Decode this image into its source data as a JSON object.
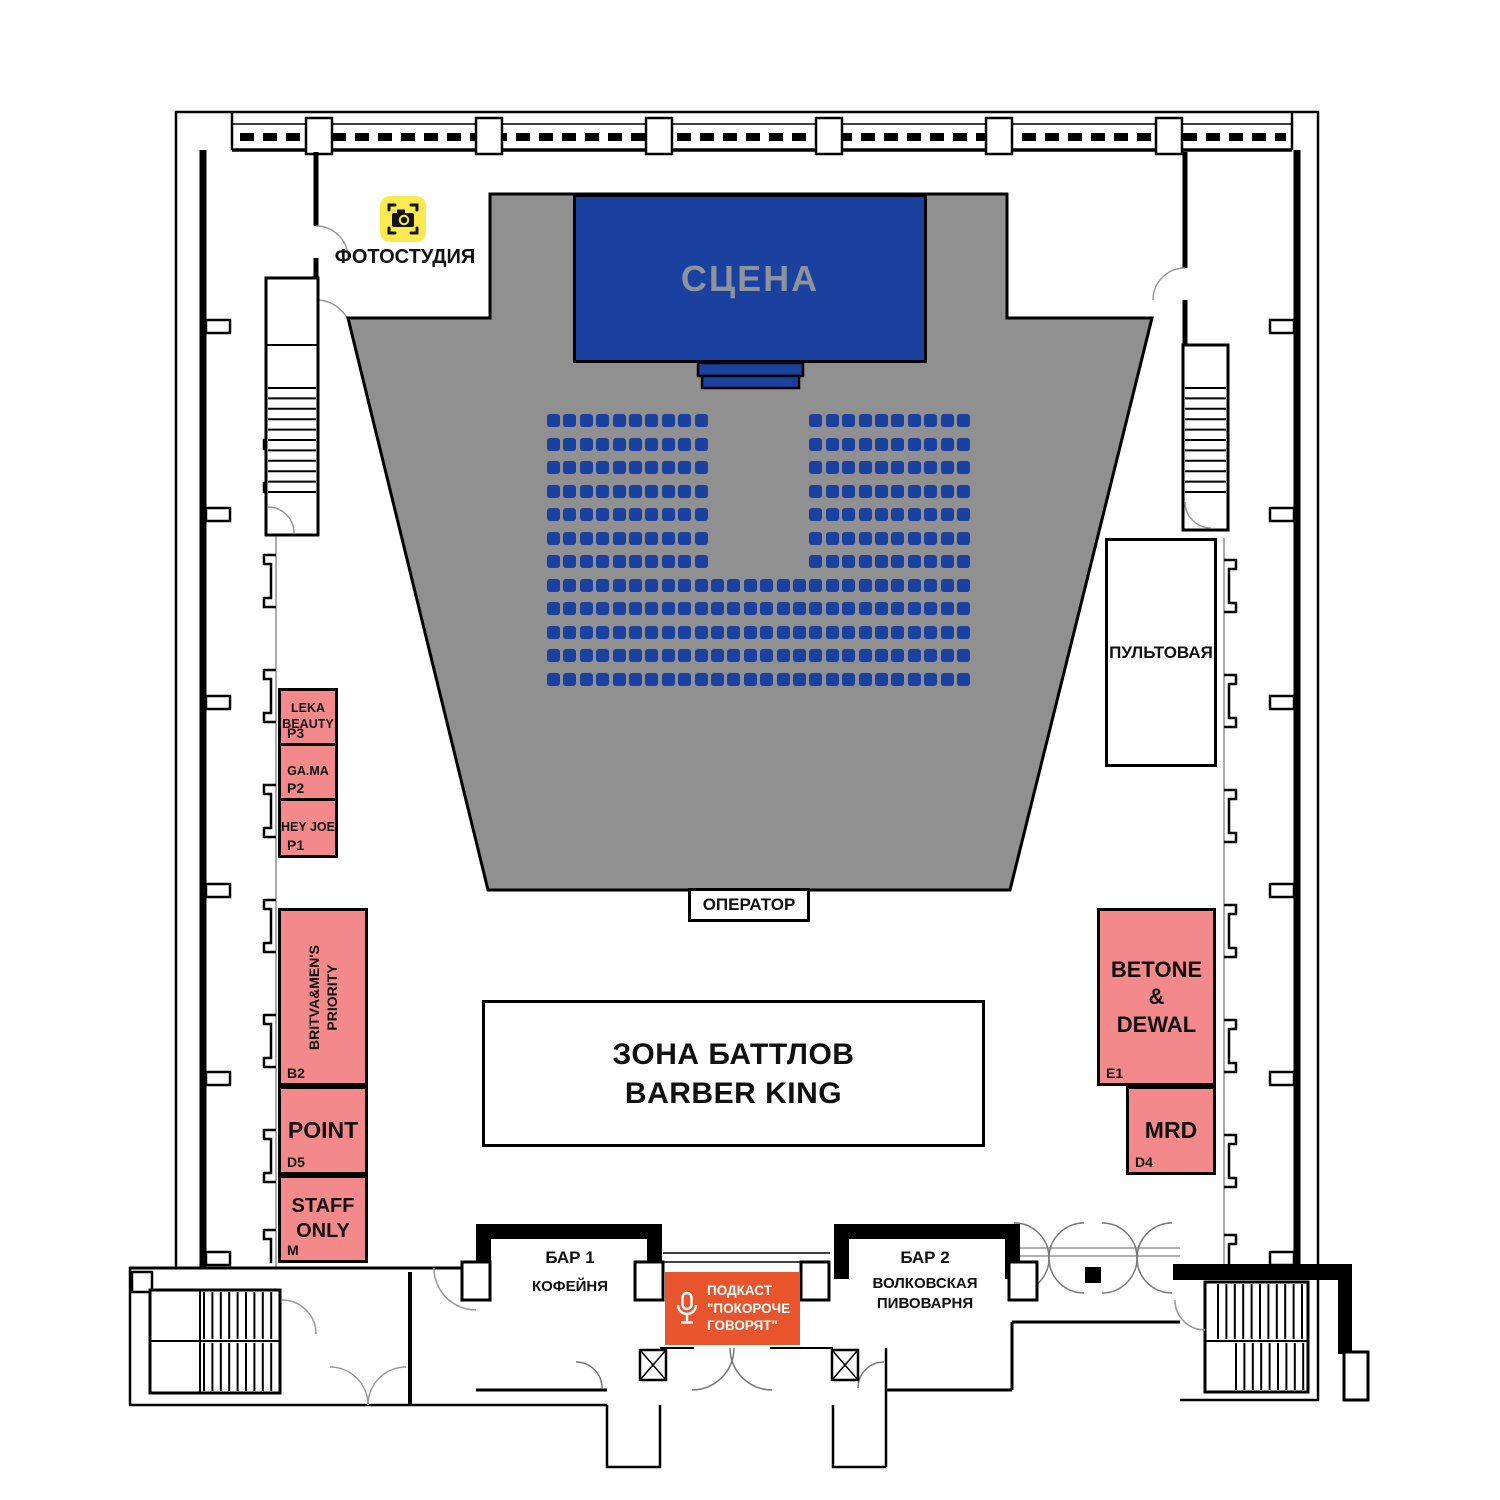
{
  "colors": {
    "audience_gray": "#909090",
    "stage_blue": "#1A41A0",
    "booth_pink": "#F4898B",
    "podcast_orange": "#E8542B",
    "icon_yellow": "#FAE94F"
  },
  "icons": {
    "photo_studio": "camera-icon",
    "podcast": "microphone-icon"
  },
  "photo_studio": {
    "label": "ФОТОСТУДИЯ"
  },
  "stage": {
    "label": "СЦЕНА"
  },
  "control_room": {
    "label": "ПУЛЬТОВАЯ"
  },
  "operator": {
    "label": "ОПЕРАТОР"
  },
  "battle_zone": {
    "line1": "ЗОНА БАТТЛОВ",
    "line2": "BARBER KING"
  },
  "booths": {
    "p3": {
      "label": "LEKA\nBEAUTY",
      "code": "P3"
    },
    "p2": {
      "label": "GA.MA",
      "code": "P2"
    },
    "p1": {
      "label": "HEY JOE",
      "code": "P1"
    },
    "b2": {
      "label": "BRITVA&MEN'S\nPRIORITY",
      "code": "B2"
    },
    "d5": {
      "label": "POINT",
      "code": "D5"
    },
    "m": {
      "label": "STAFF\nONLY",
      "code": "M"
    },
    "e1": {
      "label": "BETONE\n&\nDEWAL",
      "code": "E1"
    },
    "d4": {
      "label": "MRD",
      "code": "D4"
    }
  },
  "bars": {
    "bar1": {
      "title": "БАР 1",
      "subtitle": "КОФЕЙНЯ"
    },
    "bar2": {
      "title": "БАР 2",
      "subtitle": "ВОЛКОВСКАЯ\nПИВОВАРНЯ"
    }
  },
  "podcast": {
    "label": "ПОДКАСТ\n\"ПОКОРОЧЕ\nГОВОРЯТ\""
  },
  "seating": {
    "rows": 12,
    "cols": 26,
    "block_rows": 7,
    "gap_start": 10,
    "gap_end": 15
  }
}
